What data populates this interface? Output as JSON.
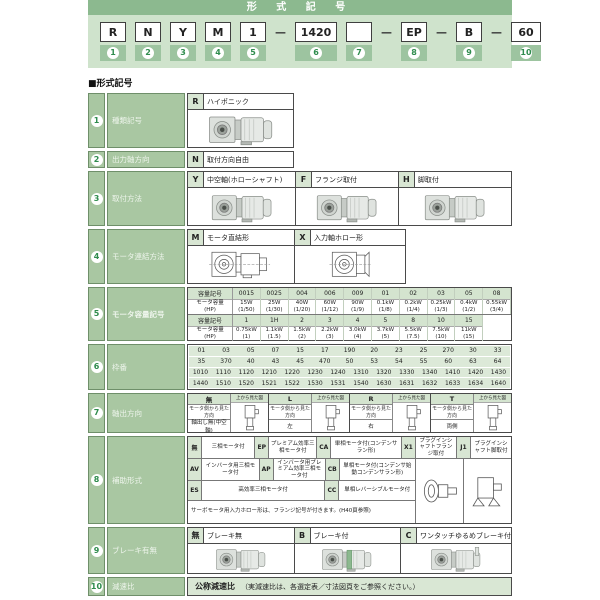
{
  "header": {
    "title": "形 式 記 号",
    "dash": "—",
    "items": [
      {
        "label": "R",
        "num": "1"
      },
      {
        "label": "N",
        "num": "2"
      },
      {
        "label": "Y",
        "num": "3"
      },
      {
        "label": "M",
        "num": "4"
      },
      {
        "label": "1",
        "num": "5"
      },
      {
        "label": "1420",
        "num": "6"
      },
      {
        "label": "",
        "num": "7"
      },
      {
        "label": "EP",
        "num": "8"
      },
      {
        "label": "B",
        "num": "9"
      },
      {
        "label": "60",
        "num": "10"
      }
    ]
  },
  "page": {
    "section_marker": "■形式記号"
  },
  "rows": {
    "r1": {
      "num": "1",
      "label": "種類記号",
      "code": "R",
      "desc": "ハイポニック"
    },
    "r2": {
      "num": "2",
      "label": "出力軸方向",
      "code": "N",
      "desc": "取付方向自由"
    },
    "r3": {
      "num": "3",
      "label": "取付方法",
      "options": [
        {
          "code": "Y",
          "desc": "中空軸(ホローシャフト)"
        },
        {
          "code": "F",
          "desc": "フランジ取付"
        },
        {
          "code": "H",
          "desc": "脚取付"
        }
      ]
    },
    "r4": {
      "num": "4",
      "label": "モータ連結方法",
      "options": [
        {
          "code": "M",
          "desc": "モータ直結形"
        },
        {
          "code": "X",
          "desc": "入力軸ホロー形"
        }
      ]
    },
    "r5": {
      "num": "5",
      "label": "モータ容量記号",
      "row_headers": {
        "code": "容量記号",
        "cap": "モータ容量",
        "hp": "(HP)"
      },
      "table1": [
        {
          "code": "0015",
          "cap": "15W",
          "hp": "(1/50)"
        },
        {
          "code": "0025",
          "cap": "25W",
          "hp": "(1/30)"
        },
        {
          "code": "004",
          "cap": "40W",
          "hp": "(1/20)"
        },
        {
          "code": "006",
          "cap": "60W",
          "hp": "(1/12)"
        },
        {
          "code": "009",
          "cap": "90W",
          "hp": "(1/9)"
        },
        {
          "code": "01",
          "cap": "0.1kW",
          "hp": "(1/8)"
        },
        {
          "code": "02",
          "cap": "0.2kW",
          "hp": "(1/4)"
        },
        {
          "code": "03",
          "cap": "0.25kW",
          "hp": "(1/3)"
        },
        {
          "code": "05",
          "cap": "0.4kW",
          "hp": "(1/2)"
        },
        {
          "code": "08",
          "cap": "0.55kW",
          "hp": "(3/4)"
        }
      ],
      "table2": [
        {
          "code": "1",
          "cap": "0.75kW",
          "hp": "(1)"
        },
        {
          "code": "1H",
          "cap": "1.1kW",
          "hp": "(1.5)"
        },
        {
          "code": "2",
          "cap": "1.5kW",
          "hp": "(2)"
        },
        {
          "code": "3",
          "cap": "2.2kW",
          "hp": "(3)"
        },
        {
          "code": "4",
          "cap": "3.0kW",
          "hp": "(4)"
        },
        {
          "code": "5",
          "cap": "3.7kW",
          "hp": "(5)"
        },
        {
          "code": "8",
          "cap": "5.5kW",
          "hp": "(7.5)"
        },
        {
          "code": "10",
          "cap": "7.5kW",
          "hp": "(10)"
        },
        {
          "code": "15",
          "cap": "11kW",
          "hp": "(15)"
        }
      ]
    },
    "r6": {
      "num": "6",
      "label": "枠番",
      "lines": [
        [
          "01",
          "03",
          "05",
          "07",
          "15",
          "17",
          "190",
          "20",
          "23",
          "25",
          "270",
          "30",
          "33"
        ],
        [
          "35",
          "370",
          "40",
          "43",
          "45",
          "470",
          "50",
          "53",
          "54",
          "55",
          "60",
          "63",
          "64"
        ],
        [
          "1010",
          "1110",
          "1120",
          "1210",
          "1220",
          "1230",
          "1240",
          "1310",
          "1320",
          "1330",
          "1340",
          "1410",
          "1420",
          "1430"
        ],
        [
          "1440",
          "1510",
          "1520",
          "1521",
          "1522",
          "1530",
          "1531",
          "1540",
          "1630",
          "1631",
          "1632",
          "1633",
          "1634",
          "1640"
        ]
      ]
    },
    "r7": {
      "num": "7",
      "label": "軸出方向",
      "top_view_label": "上から見た図",
      "view_label": "モータ側から見た方向",
      "columns": [
        {
          "code": "無",
          "value": "軸出し無(中空軸)"
        },
        {
          "code": "L",
          "value": "左"
        },
        {
          "code": "R",
          "value": "右"
        },
        {
          "code": "T",
          "value": "両側"
        }
      ]
    },
    "r8": {
      "num": "8",
      "label": "補助形式",
      "row1": [
        {
          "code": "無",
          "desc": "三相モータ付"
        },
        {
          "code": "EP",
          "desc": "プレミアム効率三相モータ付"
        },
        {
          "code": "CA",
          "desc": "単相モータ付(コンデンサラン形)"
        },
        {
          "code": "X1",
          "desc": "プラグインシャフトフランジ取付"
        },
        {
          "code": "J1",
          "desc": "プラグインシャフト脚取付"
        }
      ],
      "row2": [
        {
          "code": "AV",
          "desc": "インバータ用三相モータ付"
        },
        {
          "code": "AP",
          "desc": "インバータ用プレミアム効率三相モータ付"
        },
        {
          "code": "CB",
          "desc": "単相モータ付(コンデンサ始動コンデンサラン形)"
        }
      ],
      "row3": [
        {
          "code": "ES",
          "desc": "高効率三相モータ付"
        },
        {
          "code": "CC",
          "desc": "単相レバーシブルモータ付"
        }
      ],
      "note": "サーボモータ用入力ホロー形は、フランジ記号が付きます。(H40頁参照)"
    },
    "r9": {
      "num": "9",
      "label": "ブレーキ有無",
      "options": [
        {
          "code": "無",
          "desc": "ブレーキ無"
        },
        {
          "code": "B",
          "desc": "ブレーキ付"
        },
        {
          "code": "C",
          "desc": "ワンタッチゆるめブレーキ付"
        }
      ]
    },
    "r10": {
      "num": "10",
      "label": "減速比",
      "text1": "公称減速比",
      "text2": "（実減速比は、各選定表／寸法図頁をご参照ください。）"
    }
  },
  "colors": {
    "accent_green": "#8cb98f",
    "panel_green": "#cfe3cc",
    "label_green": "#a9c7a2",
    "chip_green": "#d8e6d3"
  }
}
